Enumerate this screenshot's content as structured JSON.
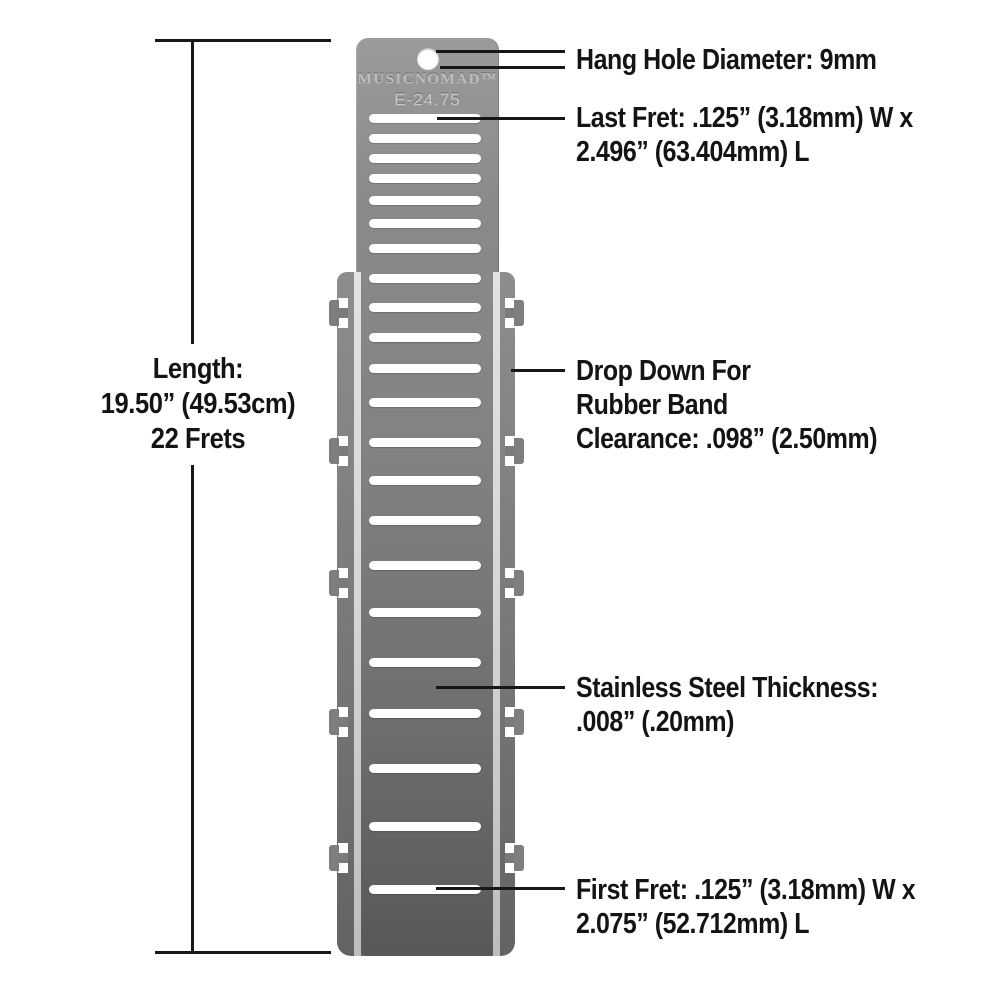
{
  "tool": {
    "brand": "MUSICNOMAD™",
    "model": "E-24.75",
    "fret_count": 22,
    "slot_ys": [
      118,
      138,
      158,
      178,
      200,
      223,
      248,
      278,
      307,
      337,
      368,
      402,
      442,
      480,
      520,
      565,
      612,
      662,
      713,
      768,
      826,
      889
    ],
    "notch_ys": [
      313,
      451,
      583,
      722,
      858
    ]
  },
  "labels": {
    "hang_hole": "Hang Hole Diameter: 9mm",
    "last_fret": [
      "Last Fret: .125” (3.18mm) W x",
      "2.496” (63.404mm) L"
    ],
    "length": [
      "Length:",
      "19.50” (49.53cm)",
      "22 Frets"
    ],
    "drop_down": [
      "Drop Down For",
      "Rubber Band",
      "Clearance: .098” (2.50mm)"
    ],
    "thickness": [
      "Stainless Steel Thickness:",
      ".008” (.20mm)"
    ],
    "first_fret": [
      "First Fret: .125” (3.18mm) W x",
      "2.075” (52.712mm) L"
    ]
  },
  "colors": {
    "ink": "#141414",
    "line": "#171717",
    "stripe": "#d5d5d5",
    "engrave": "#bdbdbd",
    "background": "#ffffff"
  }
}
